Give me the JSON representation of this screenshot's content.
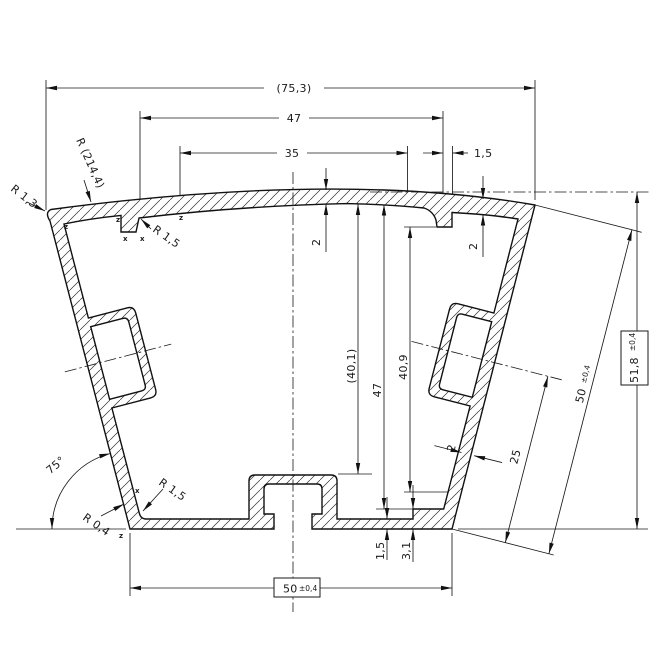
{
  "labels": {
    "overall_width": "(75,3)",
    "top_width": "47",
    "slot_width": "35",
    "offset_1_5": "1,5",
    "wall_2_center": "2",
    "wall_2_right": "2",
    "wall_2_side": "2",
    "radius_214": "R (214,4)",
    "radius_1_3": "R 1,3",
    "radius_1_5_top": "R 1,5",
    "depth_40_1": "(40,1)",
    "depth_47": "47",
    "depth_40_9": "40,9",
    "side_25": "25",
    "side_50_main": "50",
    "side_50_tol": "±0,4",
    "height_51_8_main": "51,8",
    "height_51_8_tol": "±0,4",
    "angle_75": "75°",
    "radius_1_5_bottom": "R 1,5",
    "radius_0_4": "R 0,4",
    "base_1_5": "1,5",
    "base_3_1": "3,1",
    "bottom_50_main": "50",
    "bottom_50_tol": "±0,4",
    "mark_z": "z",
    "mark_x": "x"
  },
  "colors": {
    "line": "#1a1a1a",
    "background": "#ffffff"
  }
}
